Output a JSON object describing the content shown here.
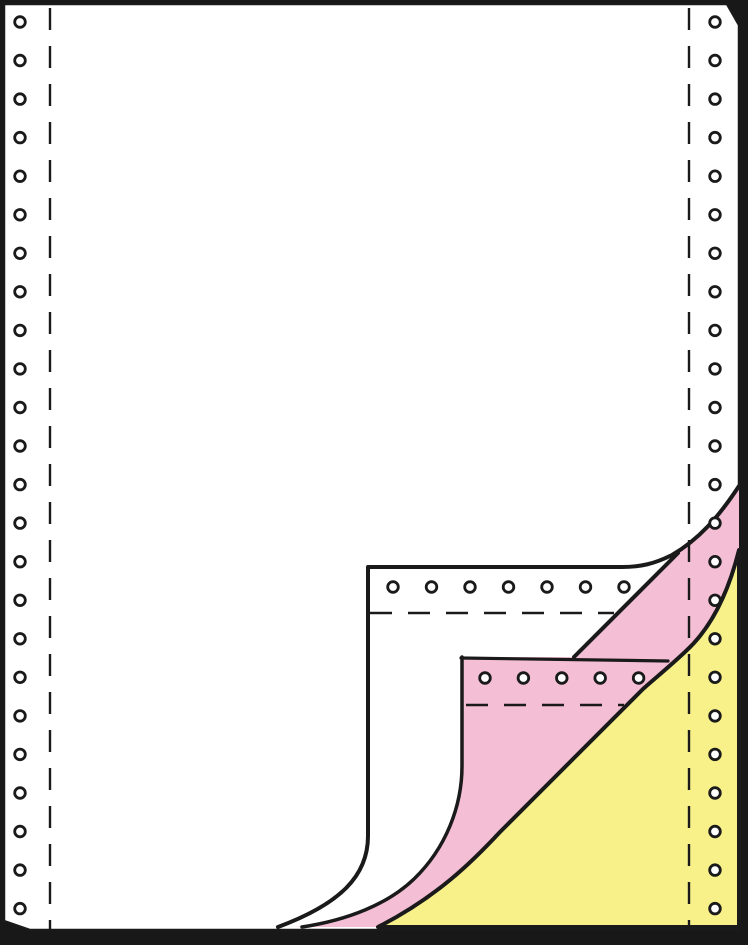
{
  "meta": {
    "description": "Product illustration of 3-ply continuous tractor-feed computer paper; bottom-right corner of the white top sheet and pink middle sheet are curled back revealing pink and yellow copy plies, all with sprocket hole margins and perforation lines"
  },
  "illustration": {
    "plies": [
      {
        "name": "white-original-sheet",
        "color": "#ffffff"
      },
      {
        "name": "pink-copy-sheet",
        "color": "#f4bed5"
      },
      {
        "name": "yellow-copy-sheet",
        "color": "#f8f18a"
      }
    ],
    "colors": {
      "frame": "#181818",
      "paper": "#ffffff",
      "pink": "#f4bed5",
      "yellow": "#f8f18a",
      "line": "#1a1a1a",
      "hole_fill": "#ffffff"
    }
  },
  "tractor_holes": {
    "radius": 5.3,
    "ring_width": 2.8,
    "rows": [
      {
        "name": "left-column",
        "x": 20,
        "y": 22,
        "dx": 0,
        "dy": 38.55,
        "count": 24
      },
      {
        "name": "right-column",
        "x": 715,
        "y": 22,
        "dx": 0,
        "dy": 38.55,
        "count": 24
      },
      {
        "name": "white-flap-row",
        "x": 393,
        "y": 587,
        "dx": 38.5,
        "dy": 0,
        "count": 7
      },
      {
        "name": "pink-flap-row",
        "x": 485,
        "y": 678,
        "dx": 38.4,
        "dy": 0,
        "count": 5
      }
    ]
  },
  "perforations": {
    "count": 4,
    "lines": [
      {
        "name": "left-vertical"
      },
      {
        "name": "right-vertical"
      },
      {
        "name": "white-flap-horizontal"
      },
      {
        "name": "pink-flap-horizontal"
      }
    ]
  }
}
